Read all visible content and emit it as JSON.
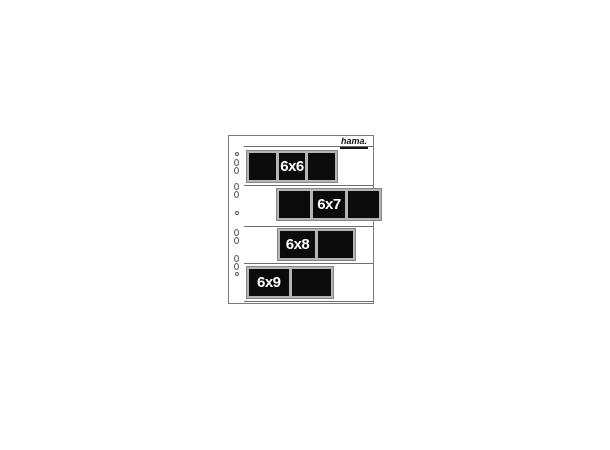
{
  "image": {
    "type": "product-photo"
  },
  "brand": {
    "logo_text": "hama."
  },
  "product": {
    "rows": [
      {
        "label": "6x6",
        "frames": 3
      },
      {
        "label": "6x7",
        "frames": 3
      },
      {
        "label": "6x8",
        "frames": 2
      },
      {
        "label": "6x9",
        "frames": 2
      }
    ],
    "binder_holes": 11
  },
  "colors": {
    "background": "#ffffff",
    "sheet-border": "#7a7a7a",
    "seam-line": "#6e6e6e",
    "film-black": "#0b0b0b",
    "strip-bg": "#b5b5b5",
    "strip-edge": "#858585",
    "hole-outline": "#5a5a5a",
    "label-text": "#ffffff",
    "logo-color": "#161616"
  }
}
